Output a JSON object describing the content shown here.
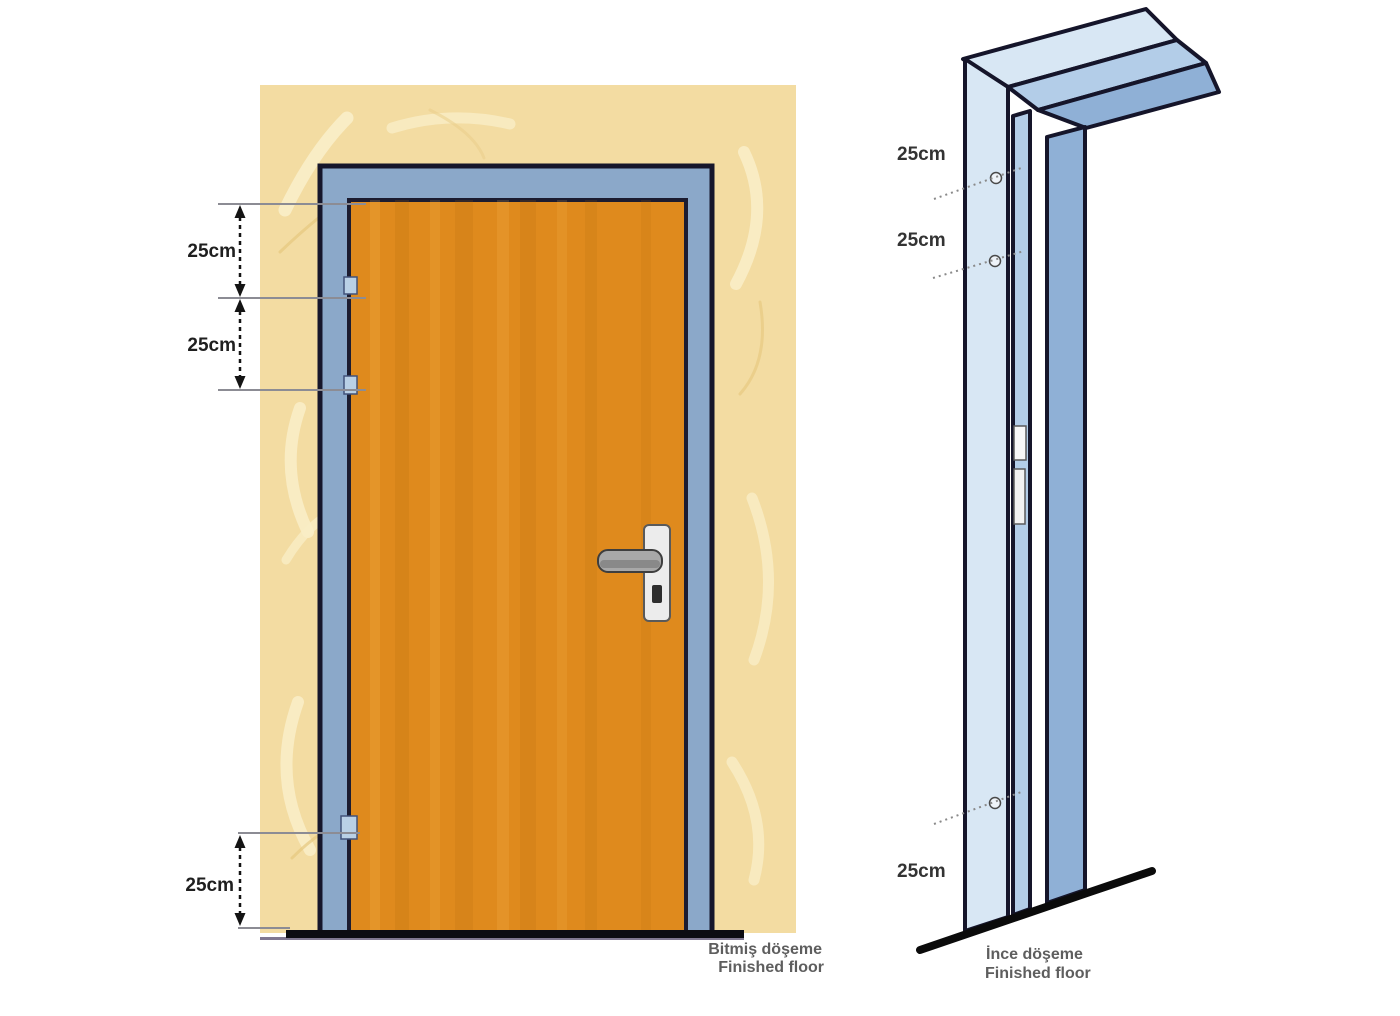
{
  "diagram": {
    "title": "door-mounting-instruction-diagram",
    "front_view": {
      "dims": [
        "25cm",
        "25cm",
        "25cm"
      ],
      "floor_label_tr": "Bitmiş döşeme",
      "floor_label_en": "Finished floor"
    },
    "perspective_view": {
      "dims": [
        "25cm",
        "25cm",
        "25cm"
      ],
      "floor_label_tr": "İnce döşeme",
      "floor_label_en": "Finished floor"
    },
    "colors": {
      "wall": "#f3dca2",
      "wall_highlight": "#faeec9",
      "frame_blue": "#8ba8c9",
      "door_orange": "#df8a1d",
      "outline": "#16162b",
      "frame_face_light": "#d8e7f4",
      "frame_face_mid": "#b3cde8",
      "frame_face_dark": "#8fb0d6",
      "hinge": "#b9d0e6",
      "handle_gray": "#a8a8a8",
      "floor_black": "#0c0c12"
    }
  }
}
